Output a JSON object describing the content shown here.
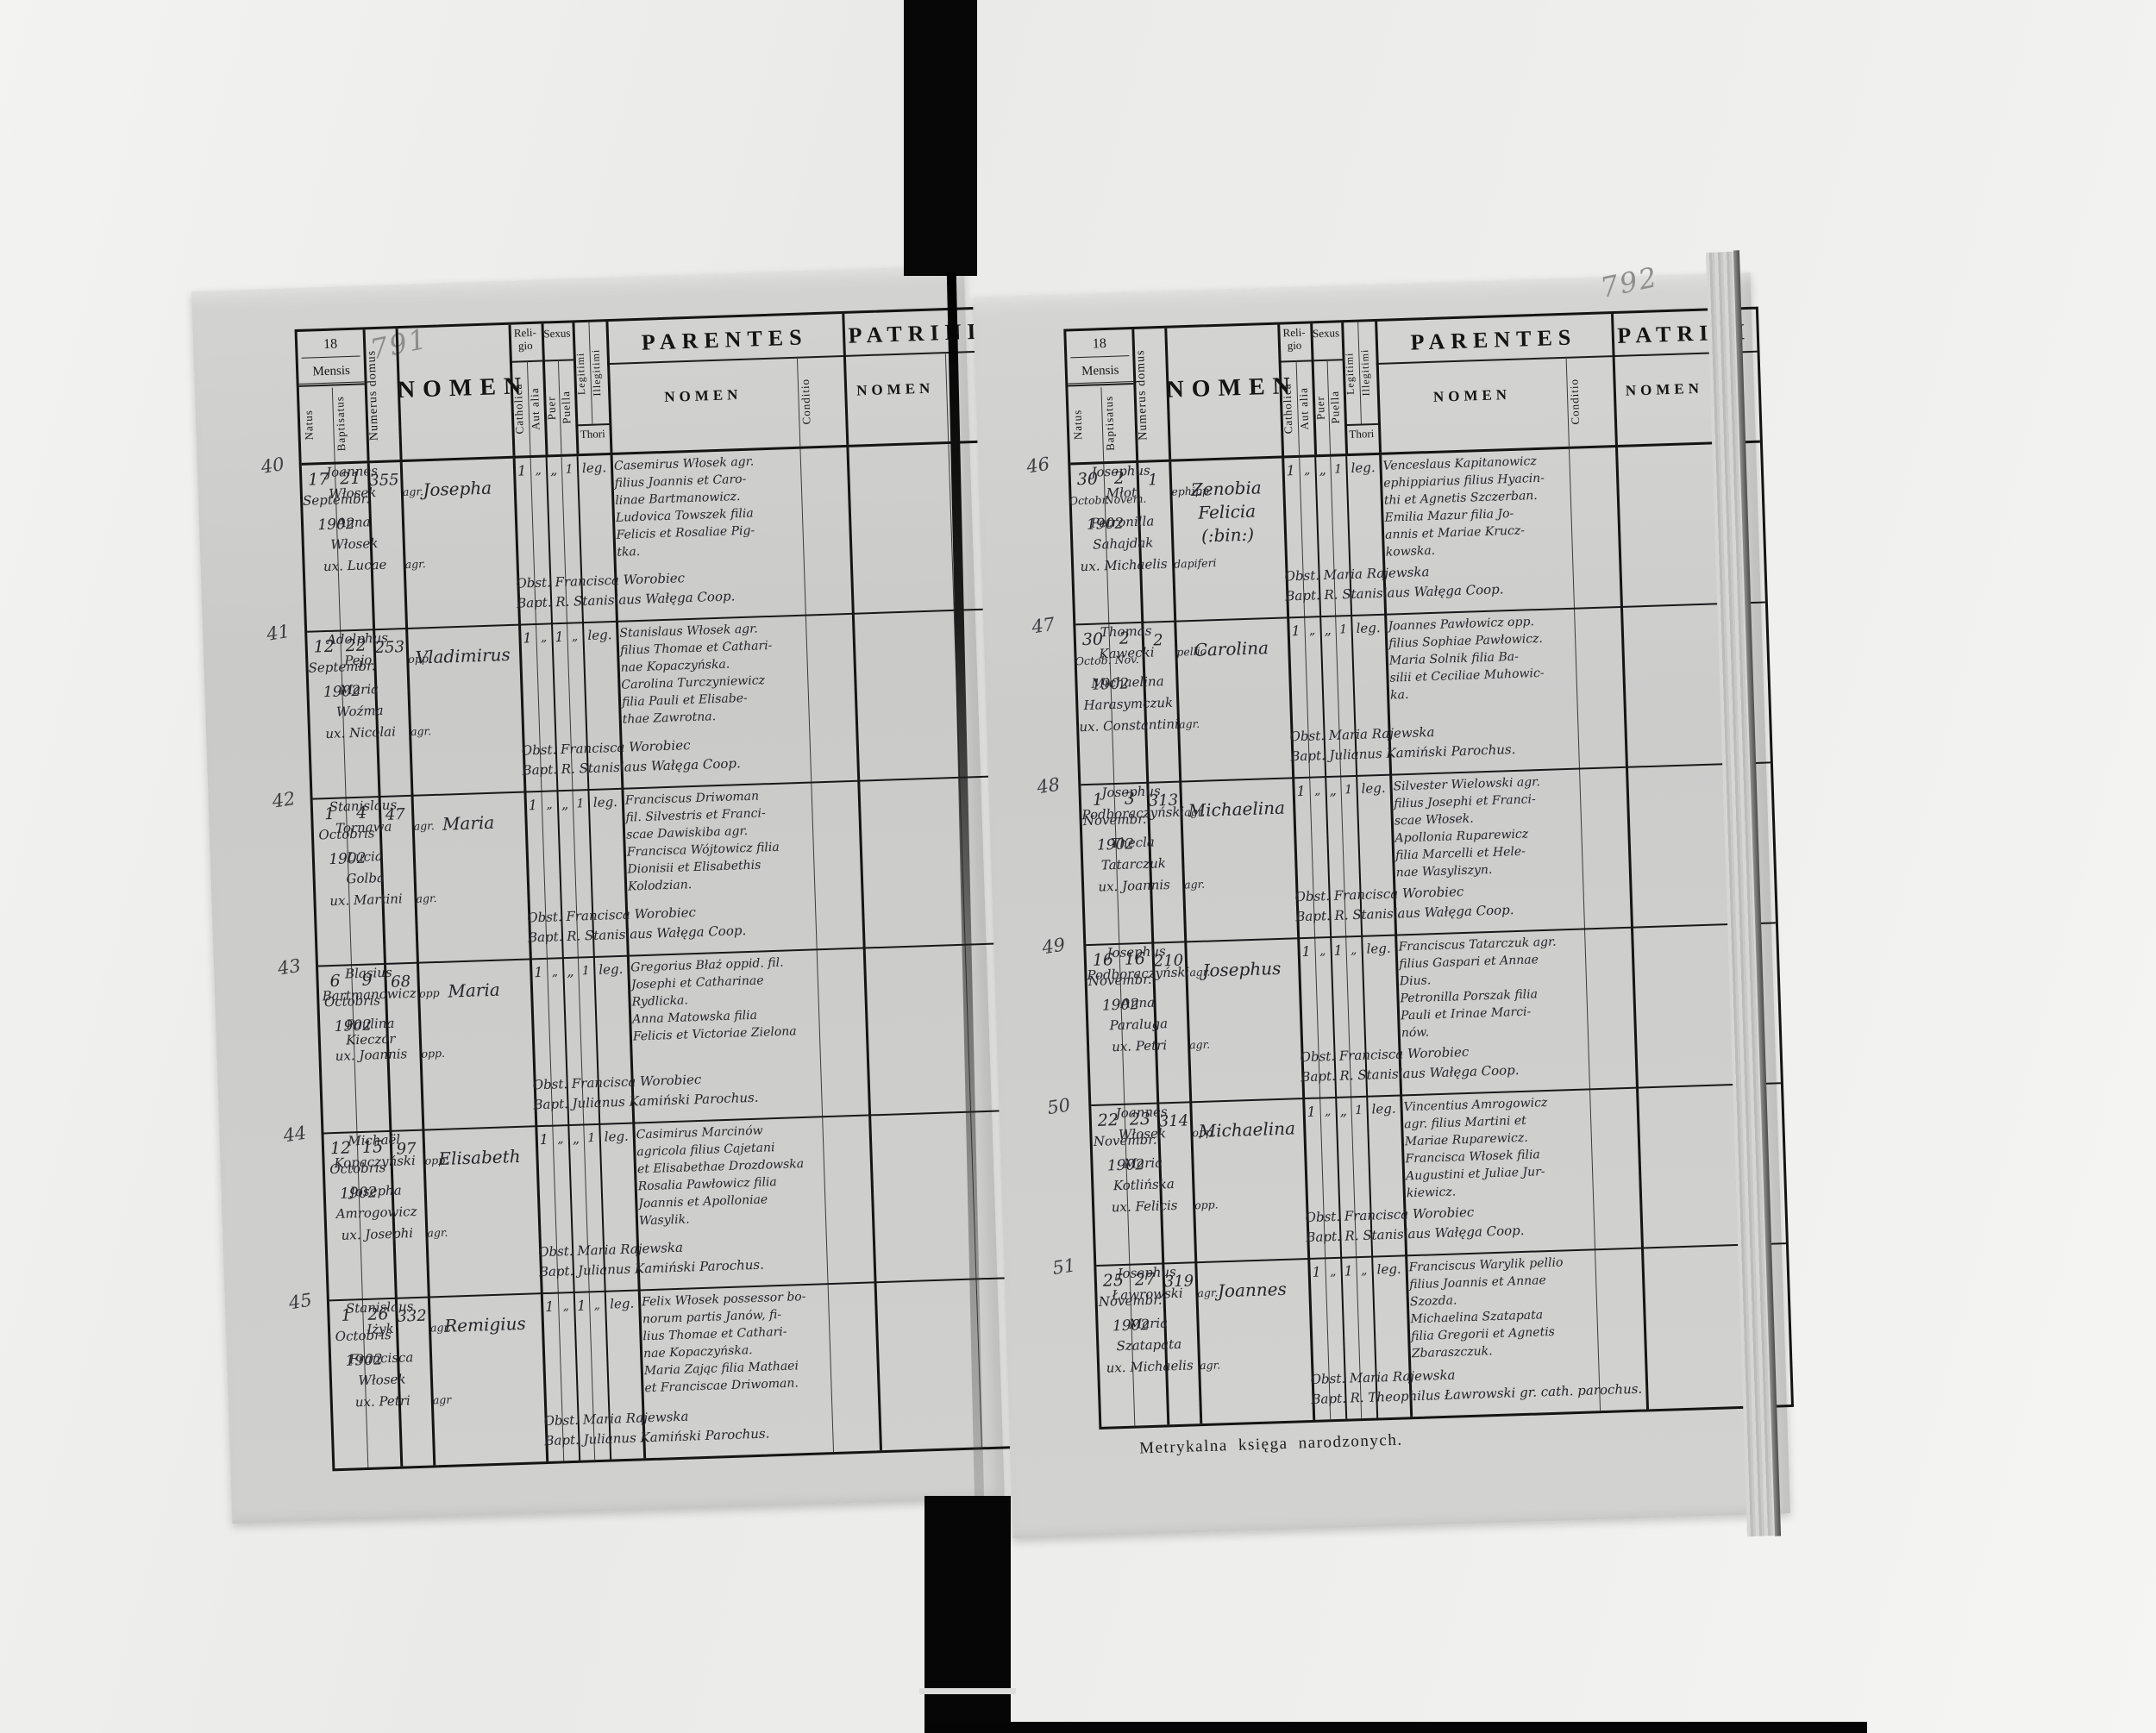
{
  "document": {
    "header": {
      "year_prefix": "18",
      "mensis": "Mensis",
      "natus": "Natus",
      "baptisatus": "Baptisatus",
      "numerus_domus": "Numerus domus",
      "nomen": "NOMEN",
      "religio": "Reli-gio",
      "catholica": "Catholica",
      "aut_alia": "Aut alia",
      "sexus": "Sexus",
      "puer": "Puer",
      "puella": "Puella",
      "legitimi": "Legitimi",
      "illegitimi": "Illegitimi",
      "thori": "Thori",
      "parentes": "PARENTES",
      "patrini": "PATRINI",
      "sub_nomen": "NOMEN",
      "conditio": "Conditio"
    },
    "pages": [
      {
        "pencil_number": "791",
        "entries": [
          {
            "margin_no": "40",
            "natus_day": "17",
            "bapt_day": "21",
            "month": "Septembr.",
            "year": "1902",
            "house_no": "355",
            "name_lines": [
              "Josepha"
            ],
            "marks": [
              "1",
              "„",
              "„",
              "1"
            ],
            "thori": "leg.",
            "parentes_lines": [
              "Casemirus Włosek agr.",
              "filius Joannis et Caro-",
              "linae Bartmanowicz.",
              "Ludovica Towszek filia",
              "Felicis et Rosaliae Pig-",
              "tka."
            ],
            "obst": "Obst. Francisca Worobiec",
            "bapt": "Bapt. R. Stanislaus Wałęga Coop.",
            "patrini": [
              {
                "t": "Joannes",
                "c": ""
              },
              {
                "t": "Włosek",
                "c": "agr."
              },
              {
                "t": "Anna",
                "c": ""
              },
              {
                "t": "Włosek",
                "c": ""
              },
              {
                "t": "ux. Lucae",
                "c": "agr."
              }
            ]
          },
          {
            "margin_no": "41",
            "natus_day": "12",
            "bapt_day": "22",
            "month": "Septembr.",
            "year": "1902",
            "house_no": "253",
            "name_lines": [
              "Vladimirus"
            ],
            "marks": [
              "1",
              "„",
              "1",
              "„"
            ],
            "thori": "leg.",
            "parentes_lines": [
              "Stanislaus Włosek agr.",
              "filius Thomae et Cathari-",
              "nae Kopaczyńska.",
              "Carolina Turczyniewicz",
              "filia Pauli et Elisabe-",
              "thae Zawrotna."
            ],
            "obst": "Obst. Francisca Worobiec",
            "bapt": "Bapt. R. Stanislaus Wałęga Coop.",
            "patrini": [
              {
                "t": "Adolphus",
                "c": ""
              },
              {
                "t": "Pejo",
                "c": "opp."
              },
              {
                "t": "Maria",
                "c": ""
              },
              {
                "t": "Woźma",
                "c": ""
              },
              {
                "t": "ux. Nicolai",
                "c": "agr."
              }
            ]
          },
          {
            "margin_no": "42",
            "natus_day": "1",
            "bapt_day": "4",
            "month": "Octobris",
            "year": "1902",
            "house_no": "47",
            "name_lines": [
              "Maria"
            ],
            "marks": [
              "1",
              "„",
              "„",
              "1"
            ],
            "thori": "leg.",
            "parentes_lines": [
              "Franciscus Driwoman",
              "fil. Silvestris et Franci-",
              "scae Dawiskiba agr.",
              "Francisca Wójtowicz filia",
              "Dionisii et Elisabethis",
              "Kolodzian."
            ],
            "obst": "Obst. Francisca Worobiec",
            "bapt": "Bapt. R. Stanislaus Wałęga Coop.",
            "patrini": [
              {
                "t": "Stanislaus",
                "c": ""
              },
              {
                "t": "Tornawa",
                "c": "agr."
              },
              {
                "t": "Lucia",
                "c": ""
              },
              {
                "t": "Golba",
                "c": ""
              },
              {
                "t": "ux. Martini",
                "c": "agr."
              }
            ]
          },
          {
            "margin_no": "43",
            "natus_day": "6",
            "bapt_day": "9",
            "month": "Octobris",
            "year": "1902",
            "house_no": "68",
            "name_lines": [
              "Maria"
            ],
            "marks": [
              "1",
              "„",
              "„",
              "1"
            ],
            "thori": "leg.",
            "parentes_lines": [
              "Gregorius Błaż oppid. fil.",
              "Josephi et Catharinae",
              "Rydlicka.",
              "Anna Matowska filia",
              "Felicis et Victoriae Zielona"
            ],
            "obst": "Obst. Francisca Worobiec",
            "bapt": "Bapt. Julianus Kamiński Parochus.",
            "patrini": [
              {
                "t": "Blasius",
                "c": ""
              },
              {
                "t": "Bartmanowicz",
                "c": "opp"
              },
              {
                "t": "Paulina Kieczór",
                "c": ""
              },
              {
                "t": "ux. Joannis",
                "c": "opp."
              }
            ]
          },
          {
            "margin_no": "44",
            "natus_day": "12",
            "bapt_day": "15",
            "month": "Octobris",
            "year": "1902",
            "house_no": "97",
            "name_lines": [
              "Elisabeth"
            ],
            "marks": [
              "1",
              "„",
              "„",
              "1"
            ],
            "thori": "leg.",
            "parentes_lines": [
              "Casimirus Marcinów",
              "agricola filius Cajetani",
              "et Elisabethae Drozdowska",
              "Rosalia Pawłowicz filia",
              "Joannis et Apolloniae",
              "Wasylik."
            ],
            "obst": "Obst. Maria Rajewska",
            "bapt": "Bapt. Julianus Kamiński Parochus.",
            "patrini": [
              {
                "t": "Michaël",
                "c": ""
              },
              {
                "t": "Kopaczyński",
                "c": "opp."
              },
              {
                "t": "Josepha",
                "c": ""
              },
              {
                "t": "Amrogowicz",
                "c": ""
              },
              {
                "t": "ux. Josephi",
                "c": "agr."
              }
            ]
          },
          {
            "margin_no": "45",
            "natus_day": "1",
            "bapt_day": "26",
            "month": "Octobris",
            "year": "1902",
            "house_no": "332",
            "name_lines": [
              "Remigius"
            ],
            "marks": [
              "1",
              "„",
              "1",
              "„"
            ],
            "thori": "leg.",
            "parentes_lines": [
              "Felix Włosek possessor bo-",
              "norum partis Janów, fi-",
              "lius Thomae et Cathari-",
              "nae Kopaczyńska.",
              "Maria Zając filia Mathaei",
              "et Franciscae Driwoman."
            ],
            "obst": "Obst. Maria Rajewska",
            "bapt": "Bapt. Julianus Kamiński Parochus.",
            "patrini": [
              {
                "t": "Stanislaus",
                "c": ""
              },
              {
                "t": "Iżyk",
                "c": "agr."
              },
              {
                "t": "Francisca",
                "c": ""
              },
              {
                "t": "Włosek",
                "c": ""
              },
              {
                "t": "ux. Petri",
                "c": "agr"
              }
            ]
          }
        ]
      },
      {
        "pencil_number": "792",
        "footer_caption": "Metrykalna księga narodzonych.",
        "printer_imprint": "Drukiem J. Pawłowskiego w Tarnopolu.",
        "entries": [
          {
            "margin_no": "46",
            "natus_day": "30",
            "bapt_day": "2",
            "months": [
              "Octobr.",
              "Novem."
            ],
            "year": "1902",
            "house_no": "1",
            "name_lines": [
              "Zenobia",
              "Felicia",
              "(:bin:)"
            ],
            "marks": [
              "1",
              "„",
              "„",
              "1"
            ],
            "thori": "leg.",
            "parentes_lines": [
              "Venceslaus Kapitanowicz",
              "ephippiarius filius Hyacin-",
              "thi et Agnetis Szczerban.",
              "Emilia Mazur filia Jo-",
              "annis et Mariae Krucz-",
              "kowska."
            ],
            "obst": "Obst. Maria Rajewska",
            "bapt": "Bapt. R. Stanislaus Wałęga Coop.",
            "patrini": [
              {
                "t": "Josephus",
                "c": ""
              },
              {
                "t": "Młot",
                "c": "ephipp."
              },
              {
                "t": "Petronilla",
                "c": ""
              },
              {
                "t": "Sahajdak",
                "c": ""
              },
              {
                "t": "ux. Michaelis",
                "c": "dapiferi"
              }
            ]
          },
          {
            "margin_no": "47",
            "natus_day": "30",
            "bapt_day": "2",
            "months": [
              "Octob.",
              "Nov."
            ],
            "year": "1902",
            "house_no": "2",
            "name_lines": [
              "Carolina"
            ],
            "marks": [
              "1",
              "„",
              "„",
              "1"
            ],
            "thori": "leg.",
            "parentes_lines": [
              "Joannes Pawłowicz opp.",
              "filius Sophiae Pawłowicz.",
              "Maria Solnik filia Ba-",
              "silii et Ceciliae Muhowic-",
              "ka."
            ],
            "obst": "Obst. Maria Rajewska",
            "bapt": "Bapt. Julianus Kamiński Parochus.",
            "patrini": [
              {
                "t": "Thomas",
                "c": ""
              },
              {
                "t": "Kawecki",
                "c": "pellio"
              },
              {
                "t": "Michaelina",
                "c": ""
              },
              {
                "t": "Harasymczuk",
                "c": ""
              },
              {
                "t": "ux. Constantini",
                "c": "agr."
              }
            ]
          },
          {
            "margin_no": "48",
            "natus_day": "1",
            "bapt_day": "3",
            "month": "Novembr.",
            "year": "1902",
            "house_no": "313",
            "name_lines": [
              "Michaelina"
            ],
            "marks": [
              "1",
              "„",
              "„",
              "1"
            ],
            "thori": "leg.",
            "parentes_lines": [
              "Silvester Wielowski agr.",
              "filius Josephi et Franci-",
              "scae Włosek.",
              "Apollonia Ruparewicz",
              "filia Marcelli et Hele-",
              "nae Wasyliszyn."
            ],
            "obst": "Obst. Francisca Worobiec",
            "bapt": "Bapt. R. Stanislaus Wałęga Coop.",
            "patrini": [
              {
                "t": "Josephus",
                "c": ""
              },
              {
                "t": "Podboraczyński",
                "c": "agr."
              },
              {
                "t": "Thecla",
                "c": ""
              },
              {
                "t": "Tatarczuk",
                "c": ""
              },
              {
                "t": "ux. Joannis",
                "c": "agr."
              }
            ]
          },
          {
            "margin_no": "49",
            "natus_day": "16",
            "bapt_day": "16",
            "month": "Novembr.",
            "year": "1902",
            "house_no": "210",
            "name_lines": [
              "Josephus"
            ],
            "marks": [
              "1",
              "„",
              "1",
              "„"
            ],
            "thori": "leg.",
            "parentes_lines": [
              "Franciscus Tatarczuk agr.",
              "filius Gaspari et Annae",
              "Dius.",
              "Petronilla Porszak filia",
              "Pauli et Irinae Marci-",
              "nów."
            ],
            "obst": "Obst. Francisca Worobiec",
            "bapt": "Bapt. R. Stanislaus Wałęga Coop.",
            "patrini": [
              {
                "t": "Josephus",
                "c": ""
              },
              {
                "t": "Podboraczyński",
                "c": "agr."
              },
              {
                "t": "Anna",
                "c": ""
              },
              {
                "t": "Paraluga",
                "c": ""
              },
              {
                "t": "ux. Petri",
                "c": "agr."
              }
            ]
          },
          {
            "margin_no": "50",
            "natus_day": "22",
            "bapt_day": "23",
            "month": "Novembr.",
            "year": "1902",
            "house_no": "314",
            "name_lines": [
              "Michaelina"
            ],
            "marks": [
              "1",
              "„",
              "„",
              "1"
            ],
            "thori": "leg.",
            "parentes_lines": [
              "Vincentius Amrogowicz",
              "agr. filius Martini et",
              "Mariae Ruparewicz.",
              "Francisca Włosek filia",
              "Augustini et Juliae Jur-",
              "kiewicz."
            ],
            "obst": "Obst. Francisca Worobiec",
            "bapt": "Bapt. R. Stanislaus Wałęga Coop.",
            "patrini": [
              {
                "t": "Joannes",
                "c": ""
              },
              {
                "t": "Włosek",
                "c": "opp."
              },
              {
                "t": "Maria",
                "c": ""
              },
              {
                "t": "Kotlińska",
                "c": ""
              },
              {
                "t": "ux. Felicis",
                "c": "opp."
              }
            ]
          },
          {
            "margin_no": "51",
            "natus_day": "25",
            "bapt_day": "27",
            "month": "Novembr.",
            "year": "1902",
            "house_no": "319",
            "name_lines": [
              "Joannes"
            ],
            "marks": [
              "1",
              "„",
              "1",
              "„"
            ],
            "thori": "leg.",
            "parentes_lines": [
              "Franciscus Warylik pellio",
              "filius Joannis et Annae",
              "Szozda.",
              "Michaelina Szatapata",
              "filia Gregorii et Agnetis",
              "Zbaraszczuk."
            ],
            "obst": "Obst. Maria Rajewska",
            "bapt": "Bapt. R. Theophilus Ławrowski gr. cath. parochus.",
            "patrini": [
              {
                "t": "Josephus",
                "c": ""
              },
              {
                "t": "Ławrowski",
                "c": "agr."
              },
              {
                "t": "Maria",
                "c": ""
              },
              {
                "t": "Szatapata",
                "c": ""
              },
              {
                "t": "ux. Michaelis",
                "c": "agr."
              }
            ]
          }
        ]
      }
    ]
  }
}
